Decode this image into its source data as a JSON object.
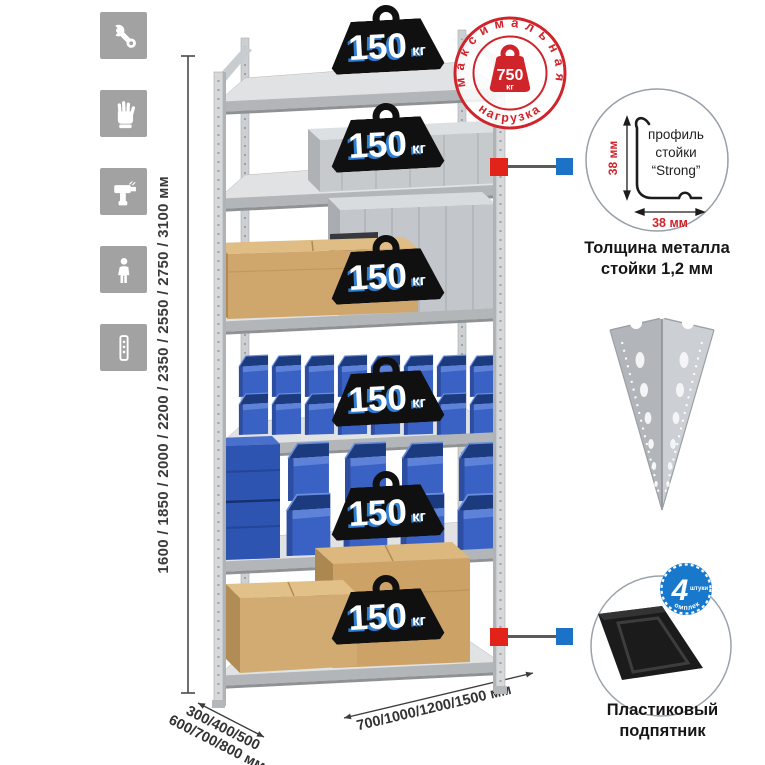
{
  "feature_icons": {
    "items": [
      {
        "icon": "wrench-icon"
      },
      {
        "icon": "work-gloves-icon"
      },
      {
        "icon": "power-drill-icon"
      },
      {
        "icon": "person-icon"
      },
      {
        "icon": "rack-post-icon"
      }
    ]
  },
  "height_dimension": {
    "label": "1600 / 1850 / 2000 / 2200 / 2350 / 2550 / 2750 / 3100 мм"
  },
  "depth_dimension": {
    "line1": "300/400/500",
    "line2": "600/700/800 мм"
  },
  "width_dimension": {
    "label": "700/1000/1200/1500 мм"
  },
  "max_load_stamp": {
    "arc_top": "максимальная",
    "arc_bottom": "нагрузка",
    "value": "750",
    "unit": "кг"
  },
  "shelf_load": {
    "value": "150",
    "unit": "кг",
    "count": 6
  },
  "profile_detail": {
    "line1": "профиль",
    "line2": "стойки",
    "line3": "“Strong”",
    "dim_vertical": "38 мм",
    "dim_horizontal": "38 мм",
    "caption_line1": "Толщина металла",
    "caption_line2": "стойки 1,2 мм"
  },
  "foot_detail": {
    "badge_value": "4",
    "badge_word": "штуки",
    "badge_arc": "в комплекте",
    "caption_line1": "Пластиковый",
    "caption_line2": "подпятник"
  },
  "colors": {
    "accent_red": "#d8232a",
    "accent_blue": "#1b72c6",
    "bin_blue": "#3a62c4",
    "cardboard": "#cfa76d",
    "metal": "#d2d4d6"
  }
}
